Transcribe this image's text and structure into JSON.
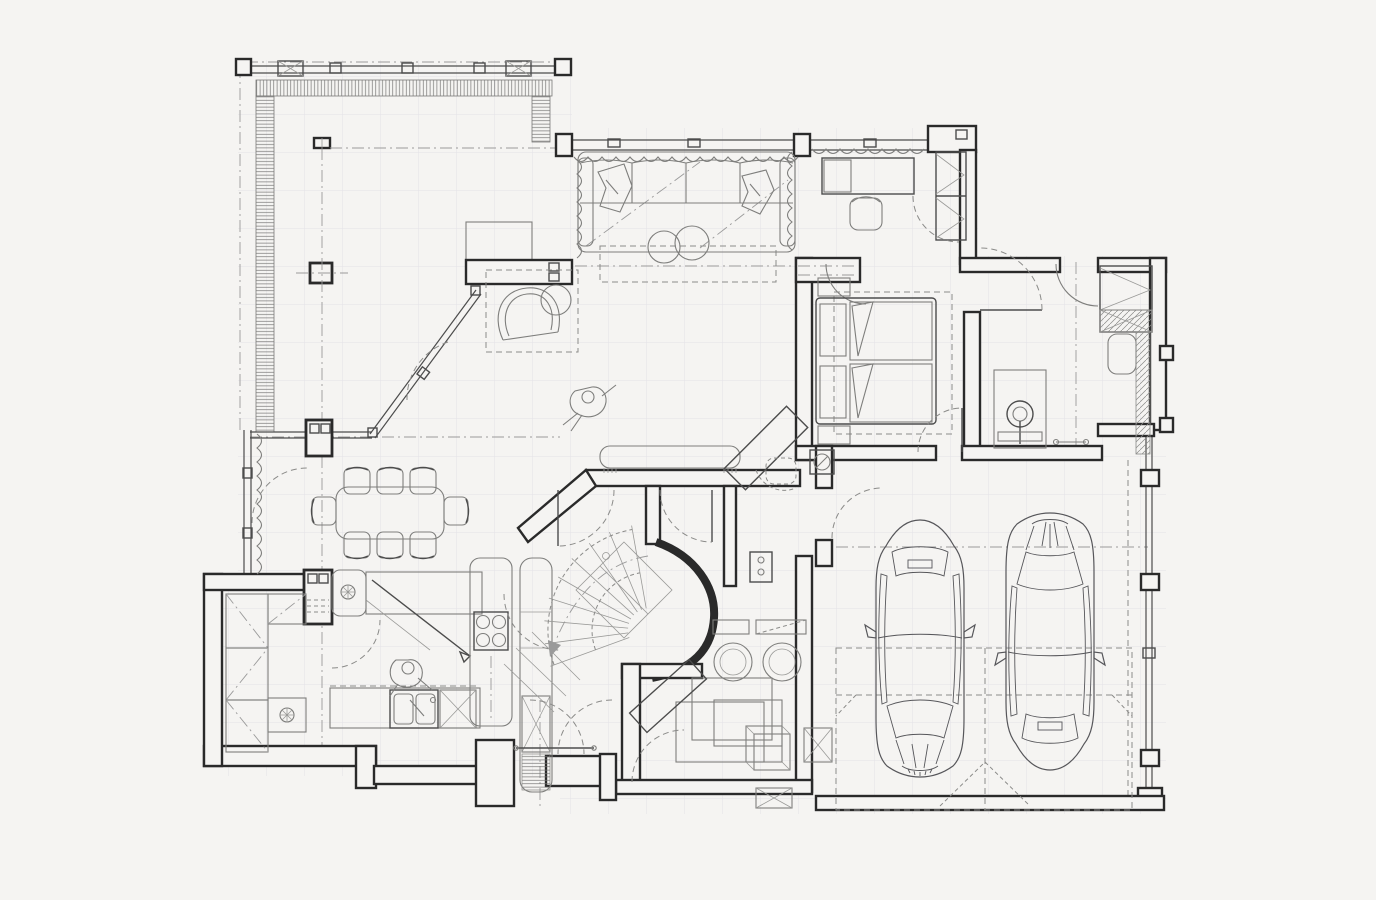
{
  "meta": {
    "title": "ground-floor-plan",
    "drawing_type": "architectural-floor-plan",
    "visible_text": []
  },
  "colors": {
    "background": "#f5f4f2",
    "wall_ink": "#2a2a2a",
    "line_ink": "#4c4c4c",
    "furniture_ink": "#7e7e7c",
    "light_ink": "#9a9a98",
    "grid": "#e3e2e7"
  },
  "rooms": [
    {
      "name": "deck-terrace"
    },
    {
      "name": "living-room"
    },
    {
      "name": "study"
    },
    {
      "name": "bedroom"
    },
    {
      "name": "bathroom"
    },
    {
      "name": "hallway"
    },
    {
      "name": "dining-area"
    },
    {
      "name": "kitchen"
    },
    {
      "name": "pantry"
    },
    {
      "name": "staircase"
    },
    {
      "name": "entry"
    },
    {
      "name": "laundry-storage"
    },
    {
      "name": "garage"
    }
  ],
  "furniture": [
    "sectional-sofa",
    "throw-pillows",
    "round-poufs",
    "area-rug",
    "armchair",
    "side-table",
    "desk",
    "desk-chair",
    "wardrobe",
    "double-bed",
    "nightstands",
    "corner-desk",
    "media-bench",
    "vanity-sink",
    "grab-bar",
    "dining-table",
    "dining-chairs",
    "kitchen-counters",
    "kitchen-sink",
    "cooktop",
    "tall-cabinet-column",
    "pantry-shelving",
    "washing-machines",
    "storage-boxes",
    "ironing-board",
    "winder-staircase",
    "curtains"
  ],
  "vehicles": [
    {
      "name": "car-left",
      "orientation": "front-facing-south"
    },
    {
      "name": "car-right",
      "orientation": "front-facing-north"
    }
  ],
  "people": [
    {
      "name": "person-walking",
      "location": "living-area"
    },
    {
      "name": "person-at-sink",
      "location": "kitchen"
    }
  ],
  "counts": {
    "dining_chairs": 8,
    "cars": 2,
    "cooktop_burners": 4,
    "sofa_seat_cushions": 4,
    "washing_machines": 2
  }
}
